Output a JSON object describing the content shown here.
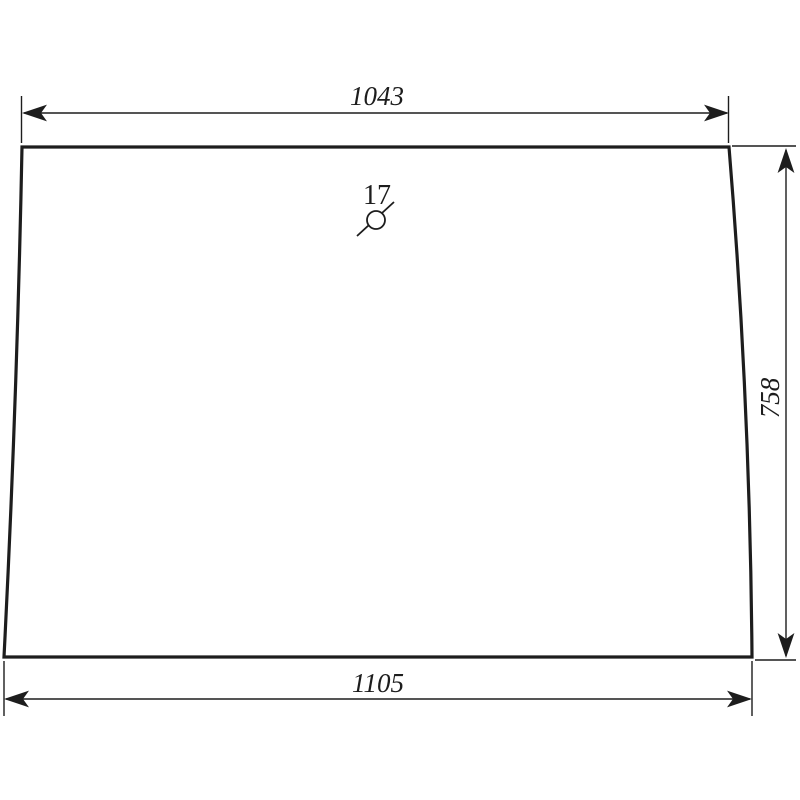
{
  "meta": {
    "background_color": "#ffffff",
    "line_color": "#1d1d1d"
  },
  "dimensions": {
    "top": {
      "value": "1043"
    },
    "right": {
      "value": "758"
    },
    "bottom": {
      "value": "1105"
    }
  },
  "callout": {
    "label": "17"
  }
}
